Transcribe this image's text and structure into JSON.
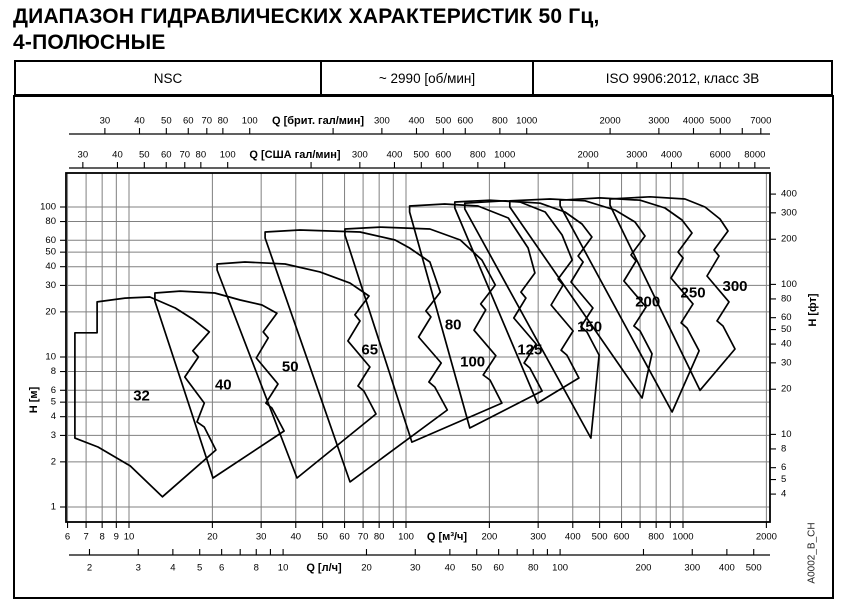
{
  "page_title": {
    "line1": "ДИАПАЗОН ГИДРАВЛИЧЕСКИХ ХАРАКТЕРИСТИК 50 Гц,",
    "line2": "4-ПОЛЮСНЫЕ"
  },
  "header": {
    "series": "NSC",
    "speed": "~ 2990 [об/мин]",
    "standard": "ISO 9906:2012, класс 3В"
  },
  "side_code": "A0002_B_CH",
  "chart_data": {
    "type": "area",
    "title": "Диапазон гидравлических характеристик NSC 50 Гц, 4-полюсные",
    "xlabel": "Q [м³/ч]",
    "ylabel": "H [м]",
    "x_log_range": [
      5.95,
      2060
    ],
    "y_log_range": [
      0.79,
      168
    ],
    "grid": {
      "x_m3h": [
        6,
        7,
        8,
        9,
        10,
        20,
        30,
        40,
        50,
        60,
        70,
        80,
        90,
        100,
        200,
        300,
        400,
        500,
        600,
        700,
        800,
        900,
        1000,
        2000
      ],
      "y_m": [
        1,
        2,
        3,
        4,
        5,
        6,
        8,
        10,
        20,
        30,
        40,
        50,
        60,
        80,
        100
      ]
    },
    "axes": {
      "imp_gpm": {
        "label": "Q [брит. гал/мин]",
        "to_m3h": 0.272765,
        "ticks": [
          30,
          40,
          50,
          60,
          70,
          80,
          100,
          200,
          300,
          400,
          500,
          600,
          800,
          1000,
          2000,
          3000,
          4000,
          5000,
          6000,
          7000
        ],
        "unlabeled": [
          200,
          6000
        ]
      },
      "us_gpm": {
        "label": "Q [США гал/мин]",
        "to_m3h": 0.227125,
        "ticks": [
          30,
          40,
          50,
          60,
          70,
          80,
          100,
          200,
          300,
          400,
          500,
          600,
          800,
          1000,
          2000,
          3000,
          4000,
          5000,
          6000,
          7000,
          8000
        ],
        "unlabeled": [
          200,
          5000,
          7000
        ]
      },
      "m3h": {
        "label": "Q [м³/ч]",
        "to_m3h": 1,
        "ticks": [
          6,
          7,
          8,
          9,
          10,
          20,
          30,
          40,
          50,
          60,
          70,
          80,
          90,
          100,
          200,
          300,
          400,
          500,
          600,
          700,
          800,
          900,
          1000,
          2000
        ],
        "unlabeled": [
          90,
          700,
          900
        ]
      },
      "lps": {
        "label": "Q [л/ч]",
        "to_m3h": 3.6,
        "ticks": [
          2,
          3,
          4,
          5,
          6,
          7,
          8,
          9,
          10,
          20,
          30,
          40,
          50,
          60,
          70,
          80,
          90,
          100,
          200,
          300,
          400,
          500
        ],
        "unlabeled": [
          7,
          9,
          70,
          90
        ]
      },
      "h_m": {
        "label": "H [м]",
        "ticks": [
          1,
          2,
          3,
          4,
          5,
          6,
          8,
          10,
          20,
          30,
          40,
          50,
          60,
          80,
          100
        ]
      },
      "h_ft": {
        "label": "H [фт]",
        "to_m": 0.3048,
        "ticks": [
          4,
          5,
          6,
          8,
          10,
          20,
          30,
          40,
          50,
          60,
          80,
          100,
          200,
          300,
          400
        ]
      }
    },
    "series": [
      {
        "name": "32",
        "label_pos": [
          11.1,
          5.5
        ],
        "points": [
          [
            6.38,
            14.5
          ],
          [
            7.67,
            14.5
          ],
          [
            7.67,
            23.3
          ],
          [
            9.67,
            24.7
          ],
          [
            11.9,
            25.1
          ],
          [
            14.7,
            21.2
          ],
          [
            17.0,
            17.9
          ],
          [
            19.5,
            14.7
          ],
          [
            17.0,
            11.0
          ],
          [
            17.8,
            10.0
          ],
          [
            15.9,
            7.36
          ],
          [
            18.7,
            4.93
          ],
          [
            17.6,
            3.69
          ],
          [
            18.7,
            3.41
          ],
          [
            20.6,
            2.4
          ],
          [
            13.2,
            1.17
          ],
          [
            10.1,
            1.88
          ],
          [
            7.73,
            2.51
          ],
          [
            6.38,
            2.88
          ]
        ]
      },
      {
        "name": "40",
        "label_pos": [
          21.9,
          6.5
        ],
        "points": [
          [
            12.4,
            23.6
          ],
          [
            12.4,
            26.7
          ],
          [
            15.3,
            27.5
          ],
          [
            20.4,
            26.7
          ],
          [
            25.2,
            24.0
          ],
          [
            30.2,
            22.2
          ],
          [
            34.2,
            19.6
          ],
          [
            30.5,
            14.7
          ],
          [
            31.8,
            13.4
          ],
          [
            28.8,
            9.85
          ],
          [
            34.5,
            6.61
          ],
          [
            31.2,
            4.93
          ],
          [
            32.8,
            4.57
          ],
          [
            36.3,
            3.21
          ],
          [
            20.1,
            1.56
          ]
        ]
      },
      {
        "name": "50",
        "label_pos": [
          38.2,
          8.6
        ],
        "points": [
          [
            20.8,
            38.0
          ],
          [
            20.8,
            41.7
          ],
          [
            26.2,
            43.0
          ],
          [
            36.6,
            41.7
          ],
          [
            48.9,
            36.9
          ],
          [
            62.8,
            31.1
          ],
          [
            73.5,
            25.5
          ],
          [
            65.4,
            19.1
          ],
          [
            68.2,
            17.4
          ],
          [
            61.7,
            12.8
          ],
          [
            74.1,
            8.58
          ],
          [
            67.1,
            6.41
          ],
          [
            70.5,
            5.93
          ],
          [
            77.9,
            4.17
          ],
          [
            40.4,
            1.56
          ]
        ]
      },
      {
        "name": "65",
        "label_pos": [
          74.0,
          11.1
        ],
        "points": [
          [
            31.0,
            62.1
          ],
          [
            31.0,
            68.1
          ],
          [
            41.4,
            70.3
          ],
          [
            68.2,
            68.1
          ],
          [
            91.3,
            60.3
          ],
          [
            103,
            53.3
          ],
          [
            122,
            43.0
          ],
          [
            133,
            27.1
          ],
          [
            118,
            20.3
          ],
          [
            123,
            18.5
          ],
          [
            111,
            13.6
          ],
          [
            134,
            9.12
          ],
          [
            121,
            6.81
          ],
          [
            127,
            6.31
          ],
          [
            141,
            4.43
          ],
          [
            62.8,
            1.47
          ]
        ]
      },
      {
        "name": "80",
        "label_pos": [
          148,
          16.3
        ],
        "points": [
          [
            60.2,
            65.1
          ],
          [
            60.2,
            71.3
          ],
          [
            80.6,
            73.5
          ],
          [
            122,
            71.3
          ],
          [
            157,
            60.3
          ],
          [
            188,
            44.3
          ],
          [
            210,
            30.2
          ],
          [
            186,
            22.6
          ],
          [
            194,
            20.6
          ],
          [
            176,
            15.1
          ],
          [
            211,
            10.2
          ],
          [
            190,
            7.59
          ],
          [
            201,
            7.03
          ],
          [
            222,
            4.93
          ],
          [
            105,
            2.71
          ]
        ]
      },
      {
        "name": "100",
        "label_pos": [
          174,
          9.26
        ],
        "points": [
          [
            103,
            92.6
          ],
          [
            103,
            101.6
          ],
          [
            138,
            104.7
          ],
          [
            182,
            101.6
          ],
          [
            234,
            84.5
          ],
          [
            276,
            53.3
          ],
          [
            292,
            36.3
          ],
          [
            260,
            27.1
          ],
          [
            271,
            24.7
          ],
          [
            245,
            18.2
          ],
          [
            295,
            12.2
          ],
          [
            267,
            9.12
          ],
          [
            280,
            8.45
          ],
          [
            310,
            5.93
          ],
          [
            170,
            3.36
          ]
        ]
      },
      {
        "name": "125",
        "label_pos": [
          280,
          11.1
        ],
        "points": [
          [
            150,
            98.5
          ],
          [
            150,
            108
          ],
          [
            201,
            111
          ],
          [
            258,
            108
          ],
          [
            318,
            92.6
          ],
          [
            366,
            65.1
          ],
          [
            398,
            44.3
          ],
          [
            354,
            33.1
          ],
          [
            369,
            30.2
          ],
          [
            334,
            22.2
          ],
          [
            401,
            14.9
          ],
          [
            363,
            11.1
          ],
          [
            381,
            10.3
          ],
          [
            421,
            7.24
          ],
          [
            298,
            4.93
          ]
        ]
      },
      {
        "name": "150",
        "label_pos": [
          460,
          15.9
        ],
        "points": [
          [
            163,
            97.0
          ],
          [
            163,
            106
          ],
          [
            228,
            110
          ],
          [
            305,
            106
          ],
          [
            375,
            92.6
          ],
          [
            432,
            77.0
          ],
          [
            469,
            63.1
          ],
          [
            418,
            47.1
          ],
          [
            436,
            43.0
          ],
          [
            394,
            31.6
          ],
          [
            473,
            21.2
          ],
          [
            428,
            15.9
          ],
          [
            450,
            14.7
          ],
          [
            498,
            10.3
          ],
          [
            465,
            2.88
          ]
        ]
      },
      {
        "name": "200",
        "label_pos": [
          746,
          23.3
        ],
        "points": [
          [
            237,
            100
          ],
          [
            237,
            110
          ],
          [
            331,
            113
          ],
          [
            443,
            110
          ],
          [
            568,
            95.5
          ],
          [
            671,
            79.4
          ],
          [
            729,
            64.1
          ],
          [
            649,
            47.9
          ],
          [
            677,
            43.7
          ],
          [
            612,
            32.1
          ],
          [
            735,
            21.5
          ],
          [
            665,
            16.1
          ],
          [
            700,
            14.9
          ],
          [
            773,
            10.5
          ],
          [
            712,
            5.33
          ]
        ]
      },
      {
        "name": "250",
        "label_pos": [
          1087,
          26.8
        ],
        "points": [
          [
            360,
            102
          ],
          [
            360,
            111
          ],
          [
            501,
            115
          ],
          [
            700,
            111
          ],
          [
            861,
            98.5
          ],
          [
            992,
            81.9
          ],
          [
            1078,
            67.1
          ],
          [
            959,
            50.1
          ],
          [
            1001,
            45.7
          ],
          [
            905,
            33.6
          ],
          [
            1087,
            22.6
          ],
          [
            984,
            16.9
          ],
          [
            1034,
            15.6
          ],
          [
            1143,
            11.0
          ],
          [
            913,
            4.3
          ]
        ]
      },
      {
        "name": "300",
        "label_pos": [
          1541,
          29.4
        ],
        "points": [
          [
            545,
            103
          ],
          [
            545,
            113
          ],
          [
            760,
            117
          ],
          [
            1017,
            113
          ],
          [
            1201,
            100
          ],
          [
            1360,
            83.2
          ],
          [
            1454,
            69.2
          ],
          [
            1294,
            51.7
          ],
          [
            1349,
            47.1
          ],
          [
            1221,
            34.7
          ],
          [
            1466,
            23.3
          ],
          [
            1327,
            17.4
          ],
          [
            1395,
            16.1
          ],
          [
            1541,
            11.3
          ],
          [
            1152,
            6.0
          ]
        ]
      }
    ],
    "colors": {
      "curve": "#000000",
      "grid": "#808080",
      "frame": "#000000",
      "background": "#ffffff"
    }
  }
}
